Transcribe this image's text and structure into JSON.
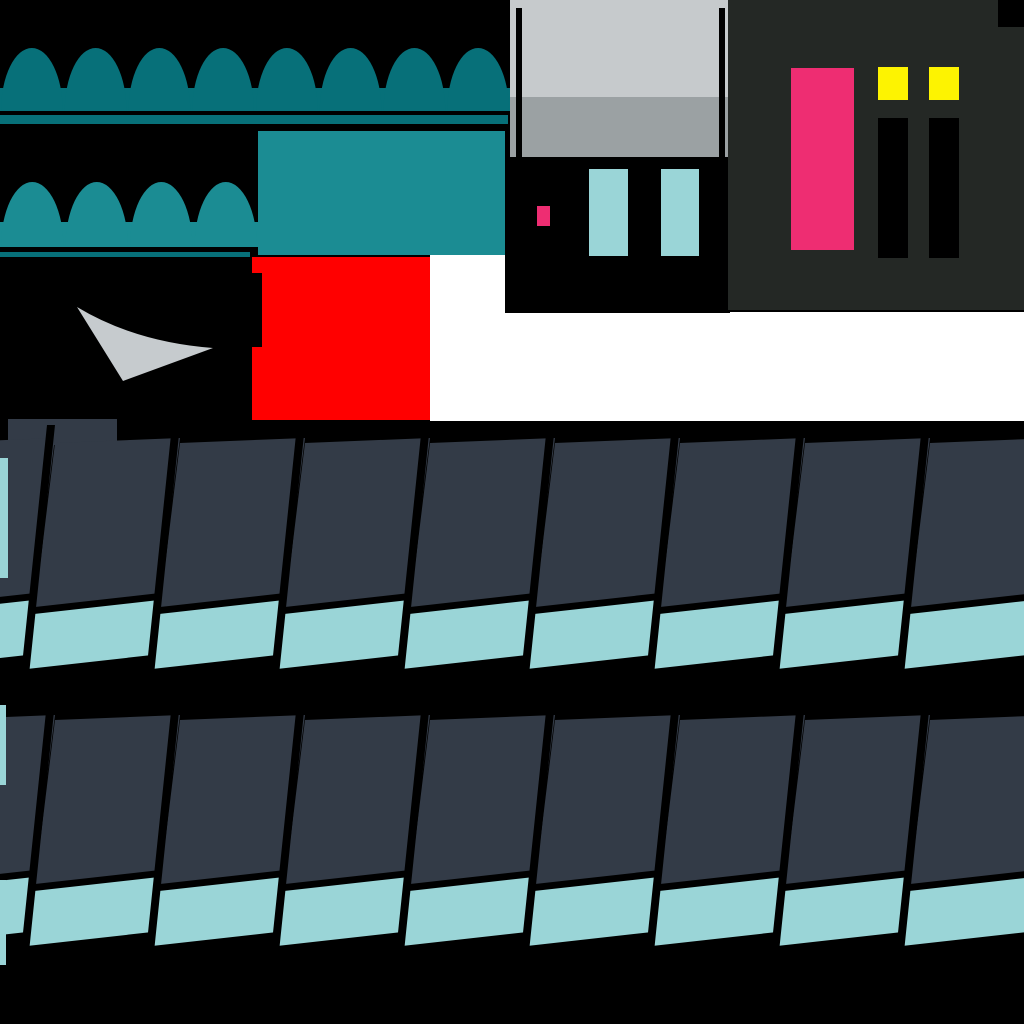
{
  "meta": {
    "kind": "game-texture-atlas",
    "width": 1024,
    "height": 1024
  },
  "palette": {
    "background": "#000000",
    "dark_teal": "#077079",
    "light_teal": "#1b8c93",
    "red": "#ff0000",
    "window_gray_top": "#c6cacc",
    "window_gray_bottom": "#9ba1a3",
    "swoosh_gray": "#c6cbce",
    "charcoal": "#242825",
    "pink": "#ee2d72",
    "yellow": "#fdf301",
    "cyan": "#9ad5d7",
    "slate": "#333b47",
    "white": "#ffffff",
    "black": "#000000"
  },
  "awning_large": {
    "x": 0,
    "width": 510,
    "scallops": 8,
    "dome_top_y": 48,
    "base_top_y": 88,
    "base_bottom_y": 111,
    "color_key": "dark_teal",
    "underline": {
      "x": 0,
      "y": 115,
      "width": 508,
      "height": 9,
      "color_key": "dark_teal"
    }
  },
  "awning_small": {
    "x": 0,
    "width": 258,
    "scallops": 4,
    "dome_top_y": 182,
    "base_top_y": 222,
    "base_bottom_y": 247,
    "color_key": "light_teal",
    "underline": {
      "x": 0,
      "y": 252,
      "width": 250,
      "height": 5,
      "color_key": "dark_teal"
    }
  },
  "teal_panel": {
    "x": 258,
    "y": 131,
    "width": 247,
    "height": 124,
    "color_key": "light_teal"
  },
  "white_backdrop": {
    "points": [
      [
        430,
        255
      ],
      [
        505,
        255
      ],
      [
        505,
        312
      ],
      [
        1024,
        312
      ],
      [
        1024,
        421
      ],
      [
        430,
        421
      ]
    ],
    "color_key": "white"
  },
  "red_panel": {
    "x": 252,
    "y": 257,
    "width": 178,
    "height": 163,
    "color_key": "red",
    "notch": {
      "x": 252,
      "y": 273,
      "width": 10,
      "height": 74,
      "color_key": "black"
    }
  },
  "gray_swoosh": {
    "path": "M 77 307 Q 135 342 213 348 L 123 381 Z",
    "color_key": "swoosh_gray"
  },
  "window": {
    "x": 510,
    "y": 0,
    "width": 218,
    "height": 157,
    "split_y": 97,
    "top_color_key": "window_gray_top",
    "bottom_color_key": "window_gray_bottom",
    "bars": {
      "xs": [
        516,
        719
      ],
      "y": 8,
      "width": 6,
      "height": 149,
      "color_key": "black"
    }
  },
  "under_window": {
    "x": 505,
    "y": 157,
    "width": 225,
    "height": 156,
    "color_key": "black",
    "pink_chip": {
      "x": 537,
      "y": 206,
      "width": 13,
      "height": 20,
      "color_key": "pink"
    },
    "cyan_panes": [
      {
        "x": 589,
        "y": 169,
        "width": 39,
        "height": 87
      },
      {
        "x": 661,
        "y": 169,
        "width": 38,
        "height": 87
      }
    ],
    "cyan_color_key": "cyan"
  },
  "charcoal_panel": {
    "x": 728,
    "y": 0,
    "width": 296,
    "height": 310,
    "color_key": "charcoal",
    "corner_notch": {
      "x": 998,
      "y": 0,
      "width": 26,
      "height": 27,
      "color_key": "black"
    },
    "pink_door": {
      "x": 791,
      "y": 68,
      "width": 63,
      "height": 182,
      "color_key": "pink"
    },
    "yellow_lights": [
      {
        "x": 878,
        "y": 67,
        "width": 30,
        "height": 33
      },
      {
        "x": 929,
        "y": 67,
        "width": 30,
        "height": 33
      }
    ],
    "yellow_color_key": "yellow",
    "dark_slots": [
      {
        "x": 878,
        "y": 118,
        "width": 30,
        "height": 140
      },
      {
        "x": 929,
        "y": 118,
        "width": 30,
        "height": 140
      }
    ],
    "slot_color_key": "black"
  },
  "roof": {
    "dark_color_key": "slate",
    "trim_color_key": "cyan",
    "gap_color_key": "black",
    "column_width": 125,
    "first_separator_top_x": 47,
    "columns": 9,
    "rows": [
      {
        "name": "roof-row-1",
        "top_y": 425,
        "cap": {
          "x": 8,
          "y": 419,
          "width": 109,
          "height": 26
        },
        "slivers": [
          {
            "x": 0,
            "y": 458,
            "width": 8,
            "height": 120
          }
        ]
      },
      {
        "name": "roof-row-2",
        "top_y": 702,
        "cap": null,
        "slivers": [
          {
            "x": 0,
            "y": 705,
            "width": 6,
            "height": 80
          },
          {
            "x": 0,
            "y": 880,
            "width": 6,
            "height": 85
          }
        ]
      }
    ],
    "geometry": {
      "dark_quad": [
        [
          8,
          18
        ],
        [
          133,
          13
        ],
        [
          113,
          168
        ],
        [
          -12,
          182
        ]
      ],
      "cyan_quad": [
        [
          -13,
          189
        ],
        [
          112,
          175
        ],
        [
          105,
          230
        ],
        [
          -20,
          244
        ]
      ],
      "separator_quad": [
        [
          0,
          0
        ],
        [
          8,
          0
        ],
        [
          -18,
          250
        ],
        [
          -26,
          250
        ]
      ]
    }
  }
}
